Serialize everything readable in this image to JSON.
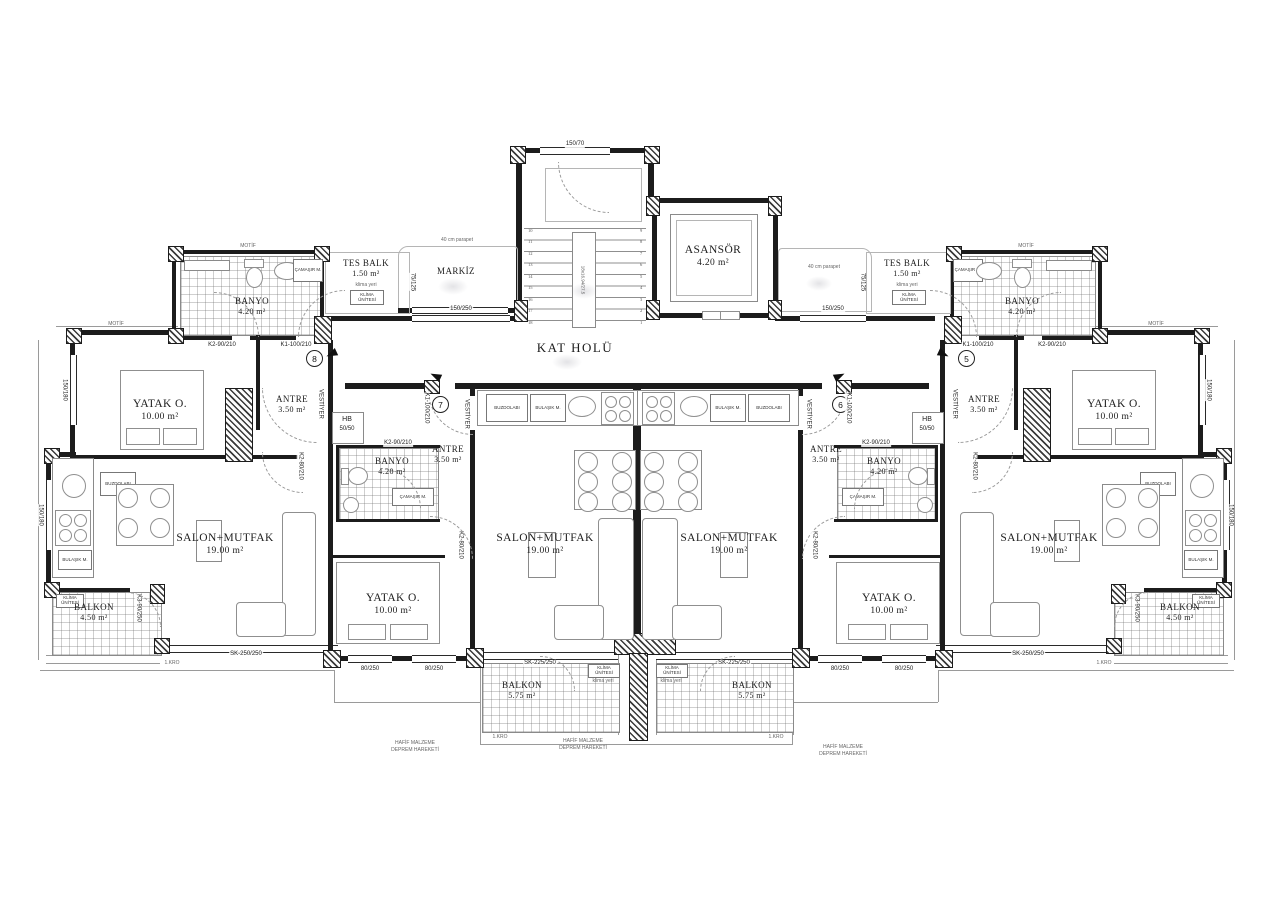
{
  "core": {
    "kat_holu": "KAT HOLÜ",
    "asansor": "ASANSÖR",
    "asansor_area": "4.20 m²",
    "markiz": "MARKİZ",
    "parapet_note": "40 cm parapet",
    "stair_window": "150/70",
    "corridor_window": "150/250",
    "stair_note": "18x16.94/27.5",
    "steps_left": [
      "10",
      "11",
      "12",
      "13",
      "14",
      "15",
      "16",
      "17",
      "18"
    ],
    "steps_right": [
      "9",
      "8",
      "7",
      "6",
      "5",
      "4",
      "3",
      "2",
      "1"
    ]
  },
  "rooms": {
    "banyo": "BANYO",
    "banyo_area": "4.20 m²",
    "tes_balk": "TES  BALK",
    "tes_balk_area": "1.50 m²",
    "yatak": "YATAK O.",
    "yatak_area": "10.00 m²",
    "antre": "ANTRE",
    "antre_area": "3.50 m²",
    "salon": "SALON+MUTFAK",
    "salon_area": "19.00 m²",
    "balkon": "BALKON",
    "balkon_side_area": "4.50 m²",
    "balkon_front_area": "5.75 m²",
    "vestiyer": "VESTİYER",
    "hb": "HB",
    "hb_size": "50/50"
  },
  "fixtures": {
    "camasir": "ÇAMAŞIR M.",
    "buzdolabi": "BUZDOLABI",
    "bulasik": "BULAŞIK M.",
    "klima_unitesi": "KLİMA ÜNİTESİ",
    "klima_yeri": "klima yeri"
  },
  "openings": {
    "k1": "K1-100/210",
    "k2_90": "K2-90/210",
    "k2_80": "K2-80/210",
    "k3": "K3-90/250",
    "w80": "80/250",
    "sk225": "SK-225/250",
    "sk250": "SK-250/250",
    "w150_250": "150/250",
    "w150_180": "150/180",
    "w75_125": "75/125"
  },
  "units": {
    "u8": "8",
    "u7": "7",
    "u6": "6",
    "u5": "5"
  },
  "notes": {
    "l1": "HAFİF MALZEME",
    "l2": "DEPREM HAREKETİ",
    "edge": "1.KRO",
    "motif": "MOTİF"
  }
}
